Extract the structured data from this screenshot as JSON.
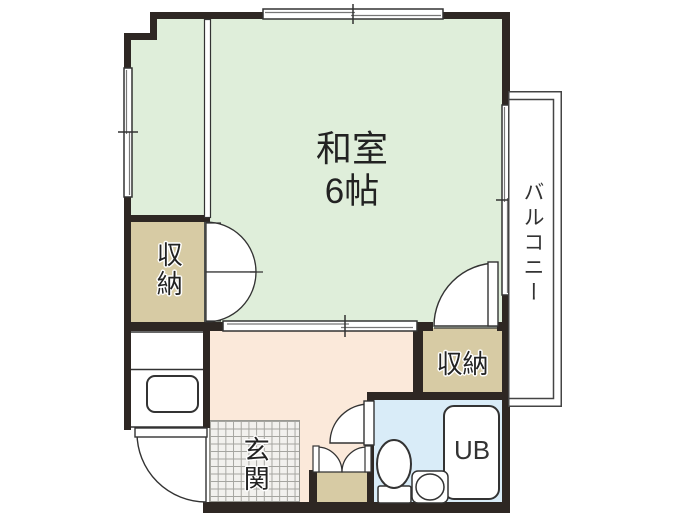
{
  "floorplan": {
    "title": "1K apartment floor plan",
    "rooms": {
      "washitsu": {
        "label": "和室",
        "size": "6帖"
      },
      "closet_left": {
        "label": "収納"
      },
      "closet_right": {
        "label": "収納"
      },
      "genkan": {
        "label": "玄関"
      },
      "balcony": {
        "label": "バルコニー"
      },
      "unit_bath": {
        "label": "UB"
      }
    },
    "colors": {
      "background": "#ffffff",
      "wall": "#2e2723",
      "washitsu": "#dfeeda",
      "closet": "#d7cba4",
      "hall": "#fbe9da",
      "unit_bath": "#d9ecf8",
      "tile_bg": "#f2f1ee",
      "tile_line": "#a5a5a0",
      "line": "#333333"
    }
  }
}
